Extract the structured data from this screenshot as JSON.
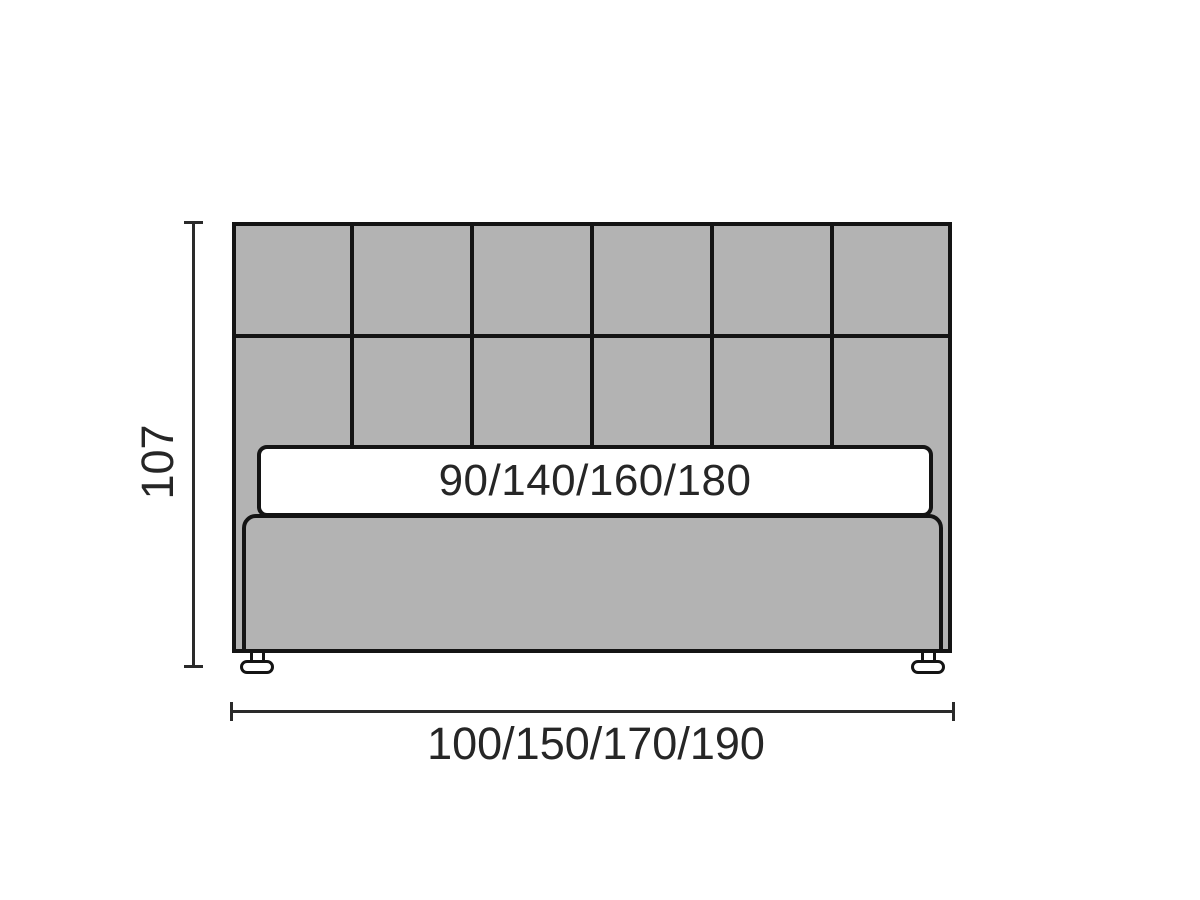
{
  "diagram": {
    "type": "furniture-dimension-diagram",
    "subject": "upholstered bed with tufted headboard, front view",
    "height_dimension": {
      "label": "107"
    },
    "width_dimension": {
      "label": "100/150/170/190"
    },
    "mattress": {
      "label": "90/140/160/180"
    },
    "headboard": {
      "columns": 6,
      "rows": 2
    },
    "colors": {
      "upholstery_gray": "#b3b3b3",
      "outline": "#141414",
      "dimension_line": "#2a2a2a",
      "text": "#262626",
      "background": "#ffffff",
      "mattress_white": "#ffffff"
    }
  }
}
